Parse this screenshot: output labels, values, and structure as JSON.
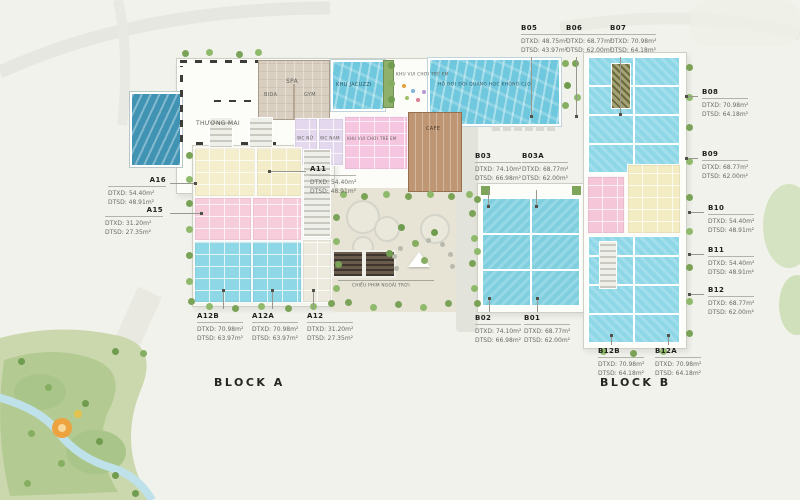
{
  "blocks": {
    "block_a": "BLOCK A",
    "block_b": "BLOCK B"
  },
  "units": [
    {
      "name": "B05",
      "dtxd": "DTXD: 48.75m²",
      "dtsd": "DTSD: 43.97m²"
    },
    {
      "name": "B06",
      "dtxd": "DTXD: 68.77m²",
      "dtsd": "DTSD: 62.00m²"
    },
    {
      "name": "B07",
      "dtxd": "DTXD: 70.98m²",
      "dtsd": "DTSD: 64.18m²"
    },
    {
      "name": "B08",
      "dtxd": "DTXD: 70.98m²",
      "dtsd": "DTSD: 64.18m²"
    },
    {
      "name": "B09",
      "dtxd": "DTXD: 68.77m²",
      "dtsd": "DTSD: 62.00m²"
    },
    {
      "name": "B10",
      "dtxd": "DTXD: 54.40m²",
      "dtsd": "DTSD: 48.91m²"
    },
    {
      "name": "B11",
      "dtxd": "DTXD: 54.40m²",
      "dtsd": "DTSD: 48.91m²"
    },
    {
      "name": "B12",
      "dtxd": "DTXD: 68.77m²",
      "dtsd": "DTSD: 62.00m²"
    },
    {
      "name": "A16",
      "dtxd": "DTXD: 54.40m²",
      "dtsd": "DTSD: 48.91m²"
    },
    {
      "name": "A15",
      "dtxd": "DTXD: 31.20m²",
      "dtsd": "DTSD: 27.35m²"
    },
    {
      "name": "A11",
      "dtxd": "DTXD: 54.40m²",
      "dtsd": "DTSD: 48.91m²"
    },
    {
      "name": "A12B",
      "dtxd": "DTXD: 70.98m²",
      "dtsd": "DTSD: 63.97m²"
    },
    {
      "name": "A12A",
      "dtxd": "DTXD: 70.98m²",
      "dtsd": "DTSD: 63.97m²"
    },
    {
      "name": "A12",
      "dtxd": "DTXD: 31.20m²",
      "dtsd": "DTSD: 27.35m²"
    },
    {
      "name": "B03",
      "dtxd": "DTXD: 74.10m²",
      "dtsd": "DTSD: 66.98m²"
    },
    {
      "name": "B03A",
      "dtxd": "DTXD: 68.77m²",
      "dtsd": "DTSD: 62.00m²"
    },
    {
      "name": "B02",
      "dtxd": "DTXD: 74.10m²",
      "dtsd": "DTSD: 66.98m²"
    },
    {
      "name": "B01",
      "dtxd": "DTXD: 68.77m²",
      "dtsd": "DTSD: 62.00m²"
    },
    {
      "name": "B12B",
      "dtxd": "DTXD: 70.98m²",
      "dtsd": "DTSD: 64.18m²"
    },
    {
      "name": "B12A",
      "dtxd": "DTXD: 70.98m²",
      "dtsd": "DTSD: 64.18m²"
    }
  ],
  "facilities": {
    "thuong_mai": "THƯƠNG MẠI",
    "spa": "SPA",
    "bida": "BIDA",
    "gym": "GYM",
    "jacuzzi": "KHU JACUZZI",
    "pool": "HỒ BƠI ĐÔI QUANG HỌC KHÔNG CLO",
    "kids_top": "KHU VUI CHƠI TRẺ EM",
    "wc_nu": "WC NỮ",
    "wc_nam": "WC NAM",
    "kids_room": "KHU VUI CHƠI TRẺ EM",
    "cafe": "CAFE",
    "cinema": "CHIẾU PHIM NGOÀI TRỜI"
  },
  "colors": {
    "unit_cyan": "#8ed7e7",
    "unit_teal": "#7fcfdf",
    "unit_cream": "#f5eecd",
    "unit_pink": "#f8cddb",
    "room_lavender": "#e4d8ee",
    "room_playpink": "#f6c6e1",
    "cafe_brown": "#bf9674",
    "pool_blue": "#6fc8de",
    "park_green": "#cbd8ad"
  }
}
